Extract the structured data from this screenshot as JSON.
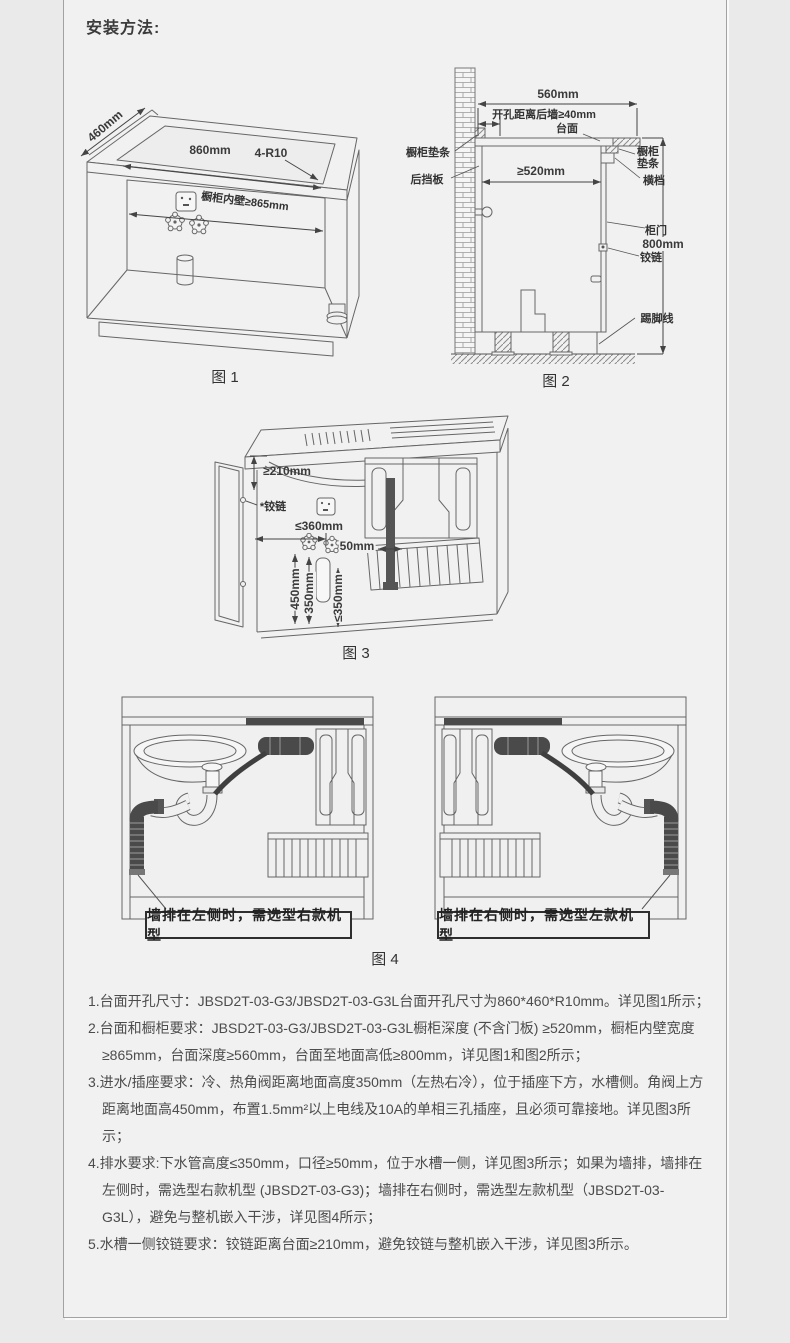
{
  "title": "安装方法:",
  "colors": {
    "page_bg": "#eaeaea",
    "card_bg": "#f1f1f1",
    "line": "#666666",
    "dark_pipe": "#4a4a4a",
    "text": "#4c4c4c"
  },
  "fig1": {
    "caption": "图 1",
    "dim_depth": "460mm",
    "dim_width": "860mm",
    "dim_corner": "4-R10",
    "dim_inner_wall": "橱柜内壁≥865mm"
  },
  "fig2": {
    "caption": "图 2",
    "dim_top_width": "560mm",
    "dim_hole_offset": "开孔距离后墙≥40mm",
    "lbl_countertop": "台面",
    "lbl_pad_left": "橱柜垫条",
    "lbl_back_board": "后挡板",
    "dim_depth": "≥520mm",
    "lbl_pad_right_1": "橱柜",
    "lbl_pad_right_2": "垫条",
    "lbl_crossbar": "横档",
    "lbl_door": "柜门",
    "lbl_hinge": "铰链",
    "dim_height": "800mm",
    "lbl_skirting": "踢脚线"
  },
  "fig3": {
    "caption": "图 3",
    "dim_hinge_offset": "≥210mm",
    "lbl_hinge": "*铰链",
    "dim_socket": "≤360mm",
    "dim_pipe": "50mm",
    "dim_valve_h": "450mm",
    "dim_inlet_h": "350mm",
    "dim_drain_h": "≤350mm"
  },
  "fig4": {
    "caption": "图 4",
    "note_left": "墙排在左侧时，需选型右款机型",
    "note_right": "墙排在右侧时，需选型左款机型"
  },
  "notes": [
    "1.台面开孔尺寸：JBSD2T-03-G3/JBSD2T-03-G3L台面开孔尺寸为860*460*R10mm。详见图1所示；",
    "2.台面和橱柜要求：JBSD2T-03-G3/JBSD2T-03-G3L橱柜深度 (不含门板) ≥520mm，橱柜内壁宽度≥865mm，台面深度≥560mm，台面至地面高低≥800mm，详见图1和图2所示；",
    "3.进水/插座要求：冷、热角阀距离地面高度350mm（左热右冷），位于插座下方，水槽侧。角阀上方距离地面高450mm，布置1.5mm²以上电线及10A的单相三孔插座，且必须可靠接地。详见图3所示；",
    "4.排水要求:下水管高度≤350mm，口径≥50mm，位于水槽一侧，详见图3所示；如果为墙排，墙排在左侧时，需选型右款机型 (JBSD2T-03-G3)；墙排在右侧时，需选型左款机型（JBSD2T-03-G3L），避免与整机嵌入干涉，详见图4所示；",
    "5.水槽一侧铰链要求：铰链距离台面≥210mm，避免铰链与整机嵌入干涉，详见图3所示。"
  ]
}
